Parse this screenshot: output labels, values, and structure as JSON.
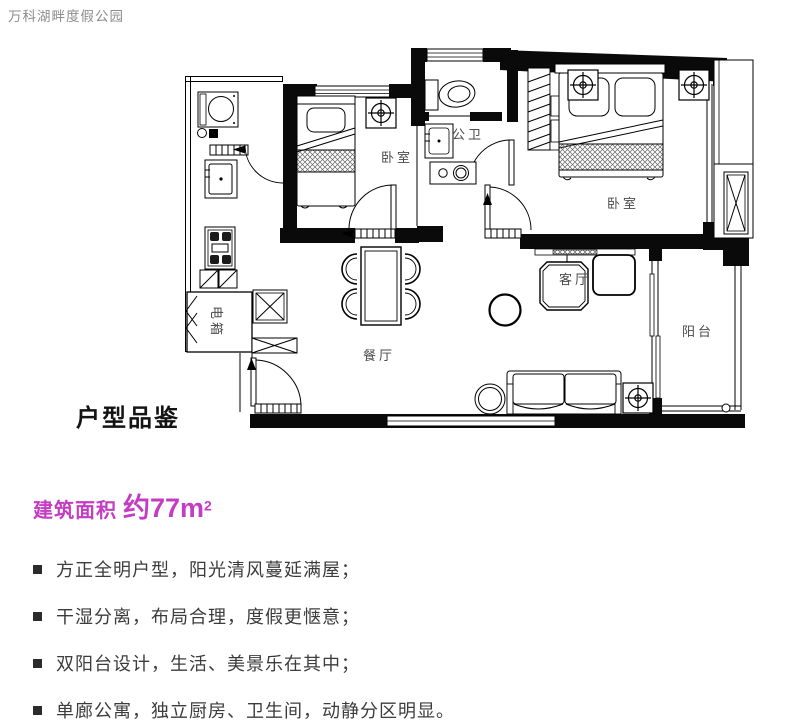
{
  "header": {
    "project_name": "万科湖畔度假公园"
  },
  "floor_plan": {
    "labels": {
      "bedroom_left": "卧室",
      "bathroom": "公卫",
      "bedroom_right": "卧室",
      "living_room": "客厅",
      "dining_room": "餐厅",
      "balcony": "阳台",
      "electric_box": "电箱"
    }
  },
  "section": {
    "title": "户型品鉴"
  },
  "area": {
    "label": "建筑面积",
    "value": "约77m",
    "superscript": "2",
    "color": "#c43cc4"
  },
  "features": {
    "items": [
      "方正全明户型，阳光清风蔓延满屋；",
      "干湿分离，布局合理，度假更惬意；",
      "双阳台设计，生活、美景乐在其中；",
      "单廊公寓，独立厨房、卫生间，动静分区明显。"
    ]
  },
  "colors": {
    "accent": "#c43cc4",
    "wall": "#0a0a0a",
    "title_gray": "#8d8d8d"
  }
}
